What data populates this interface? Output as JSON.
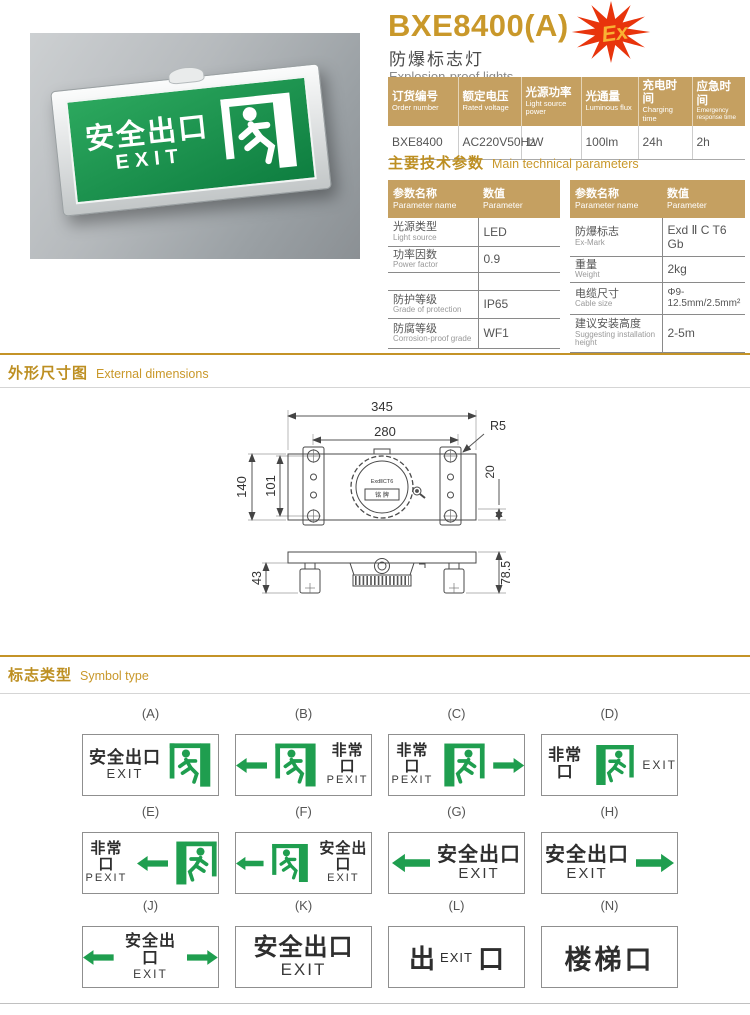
{
  "header": {
    "model": "BXE8400(A)",
    "name_cn": "防爆标志灯",
    "name_en": "Explosion-proof lights",
    "ex_mark": "Ex"
  },
  "colors": {
    "gold_accent": "#C9982A",
    "table_header_bg": "#C5A061",
    "sign_green": "#1F9E4F",
    "star_red": "#E8380D",
    "ex_text_gold": "#F9B233"
  },
  "order_table": {
    "headers": [
      {
        "cn": "订货编号",
        "en": "Order number"
      },
      {
        "cn": "额定电压",
        "en": "Rated voltage"
      },
      {
        "cn": "光源功率",
        "en": "Light source power"
      },
      {
        "cn": "光通量",
        "en": "Luminous flux"
      },
      {
        "cn": "充电时间",
        "en": "Charging time"
      },
      {
        "cn": "应急时间",
        "en": "Emergency response time"
      }
    ],
    "row": [
      "BXE8400",
      "AC220V50Hz",
      "1W",
      "100lm",
      "24h",
      "2h"
    ]
  },
  "sections": {
    "params_cn": "主要技术参数",
    "params_en": "Main technical parameters",
    "dims_cn": "外形尺寸图",
    "dims_en": "External dimensions",
    "symbols_cn": "标志类型",
    "symbols_en": "Symbol type"
  },
  "param_header": {
    "name_cn": "参数名称",
    "name_en": "Parameter name",
    "val_cn": "数值",
    "val_en": "Parameter"
  },
  "param_left": {
    "rows": [
      {
        "cn": "光源类型",
        "en": "Light source",
        "val": "LED"
      },
      {
        "cn": "功率因数",
        "en": "Power factor",
        "val": "0.9"
      },
      {
        "cn": "",
        "en": "",
        "val": ""
      },
      {
        "cn": "防护等级",
        "en": "Grade of protection",
        "val": "IP65"
      },
      {
        "cn": "防腐等级",
        "en": "Corrosion-proof grade",
        "val": "WF1"
      }
    ]
  },
  "param_right": {
    "rows": [
      {
        "cn": "防爆标志",
        "en": "Ex-Mark",
        "val": "Exd Ⅱ C T6 Gb"
      },
      {
        "cn": "重量",
        "en": "Weight",
        "val": "2kg"
      },
      {
        "cn": "电缆尺寸",
        "en": "Cable size",
        "val": "Φ9-12.5mm/2.5mm²"
      },
      {
        "cn": "建议安装高度",
        "en": "Suggesting installation height",
        "val": "2-5m"
      }
    ]
  },
  "drawing": {
    "w_total": "345",
    "w_inner": "280",
    "corner": "R5",
    "h_total": "140",
    "hole_span": "101",
    "edge": "20",
    "foot": "43",
    "depth": "78.5",
    "dial": "ExdⅡCT6",
    "plate": "铭 牌"
  },
  "photo": {
    "line1": "安全出口",
    "line2": "EXIT"
  },
  "symbols": {
    "cells": {
      "a": {
        "label": "(A)",
        "cn": "安全出口",
        "en": "EXIT"
      },
      "b": {
        "label": "(B)",
        "cn": "非常口",
        "en": "PEXIT"
      },
      "c": {
        "label": "(C)",
        "cn": "非常口",
        "en": "PEXIT"
      },
      "d": {
        "label": "(D)",
        "cn": "非常口",
        "en": "EXIT"
      },
      "e": {
        "label": "(E)",
        "cn": "非常口",
        "en": "PEXIT"
      },
      "f": {
        "label": "(F)",
        "cn": "安全出口",
        "en": "EXIT"
      },
      "g": {
        "label": "(G)",
        "cn": "安全出口",
        "en": "EXIT"
      },
      "h": {
        "label": "(H)",
        "cn": "安全出口",
        "en": "EXIT"
      },
      "j": {
        "label": "(J)",
        "cn": "安全出口",
        "en": "EXIT"
      },
      "k": {
        "label": "(K)",
        "cn": "安全出口",
        "en": "EXIT"
      },
      "l": {
        "label": "(L)",
        "p1": "出",
        "p2": "EXIT",
        "p3": "口"
      },
      "n": {
        "label": "(N)",
        "text": "楼梯口"
      }
    }
  }
}
